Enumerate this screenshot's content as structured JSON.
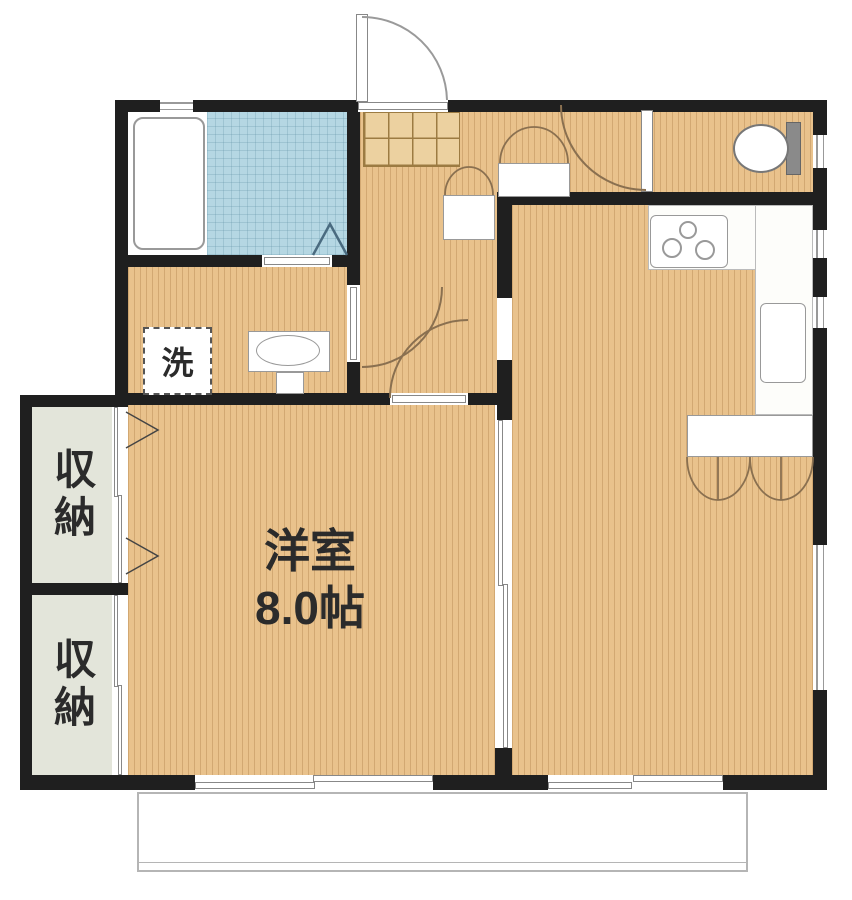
{
  "floorplan": {
    "type": "japanese-apartment-floor-plan",
    "labels": {
      "western_room_name": "洋室",
      "western_room_size": "8.0帖",
      "storage_top": "収納",
      "storage_bottom": "収納",
      "laundry": "洗"
    },
    "fixtures": [
      "bathtub",
      "bathroom-tile-area",
      "bath-folding-door",
      "washing-machine-space",
      "washbasin",
      "toilet",
      "shoe-cabinet",
      "entrance-door",
      "toilet-door",
      "washroom-door",
      "bedroom-door",
      "hall-closet",
      "kitchen-stove",
      "kitchen-counter",
      "kitchen-sink",
      "living-closet",
      "sliding-partition",
      "storage-closet",
      "balcony",
      "sliding-windows"
    ],
    "colors": {
      "wall": "#1f1f1f",
      "wood": "#e9c28c",
      "tile": "#b5d7e3",
      "storage": "#e3e5da",
      "shoe": "#ecd1a0",
      "shoe_grid": "#9c7b42",
      "white": "#ffffff",
      "outline": "#999999",
      "door": "#8a7050",
      "bath_door": "#4a6b80",
      "balcony": "#b5b5b5",
      "text": "#2b2b2b"
    }
  }
}
